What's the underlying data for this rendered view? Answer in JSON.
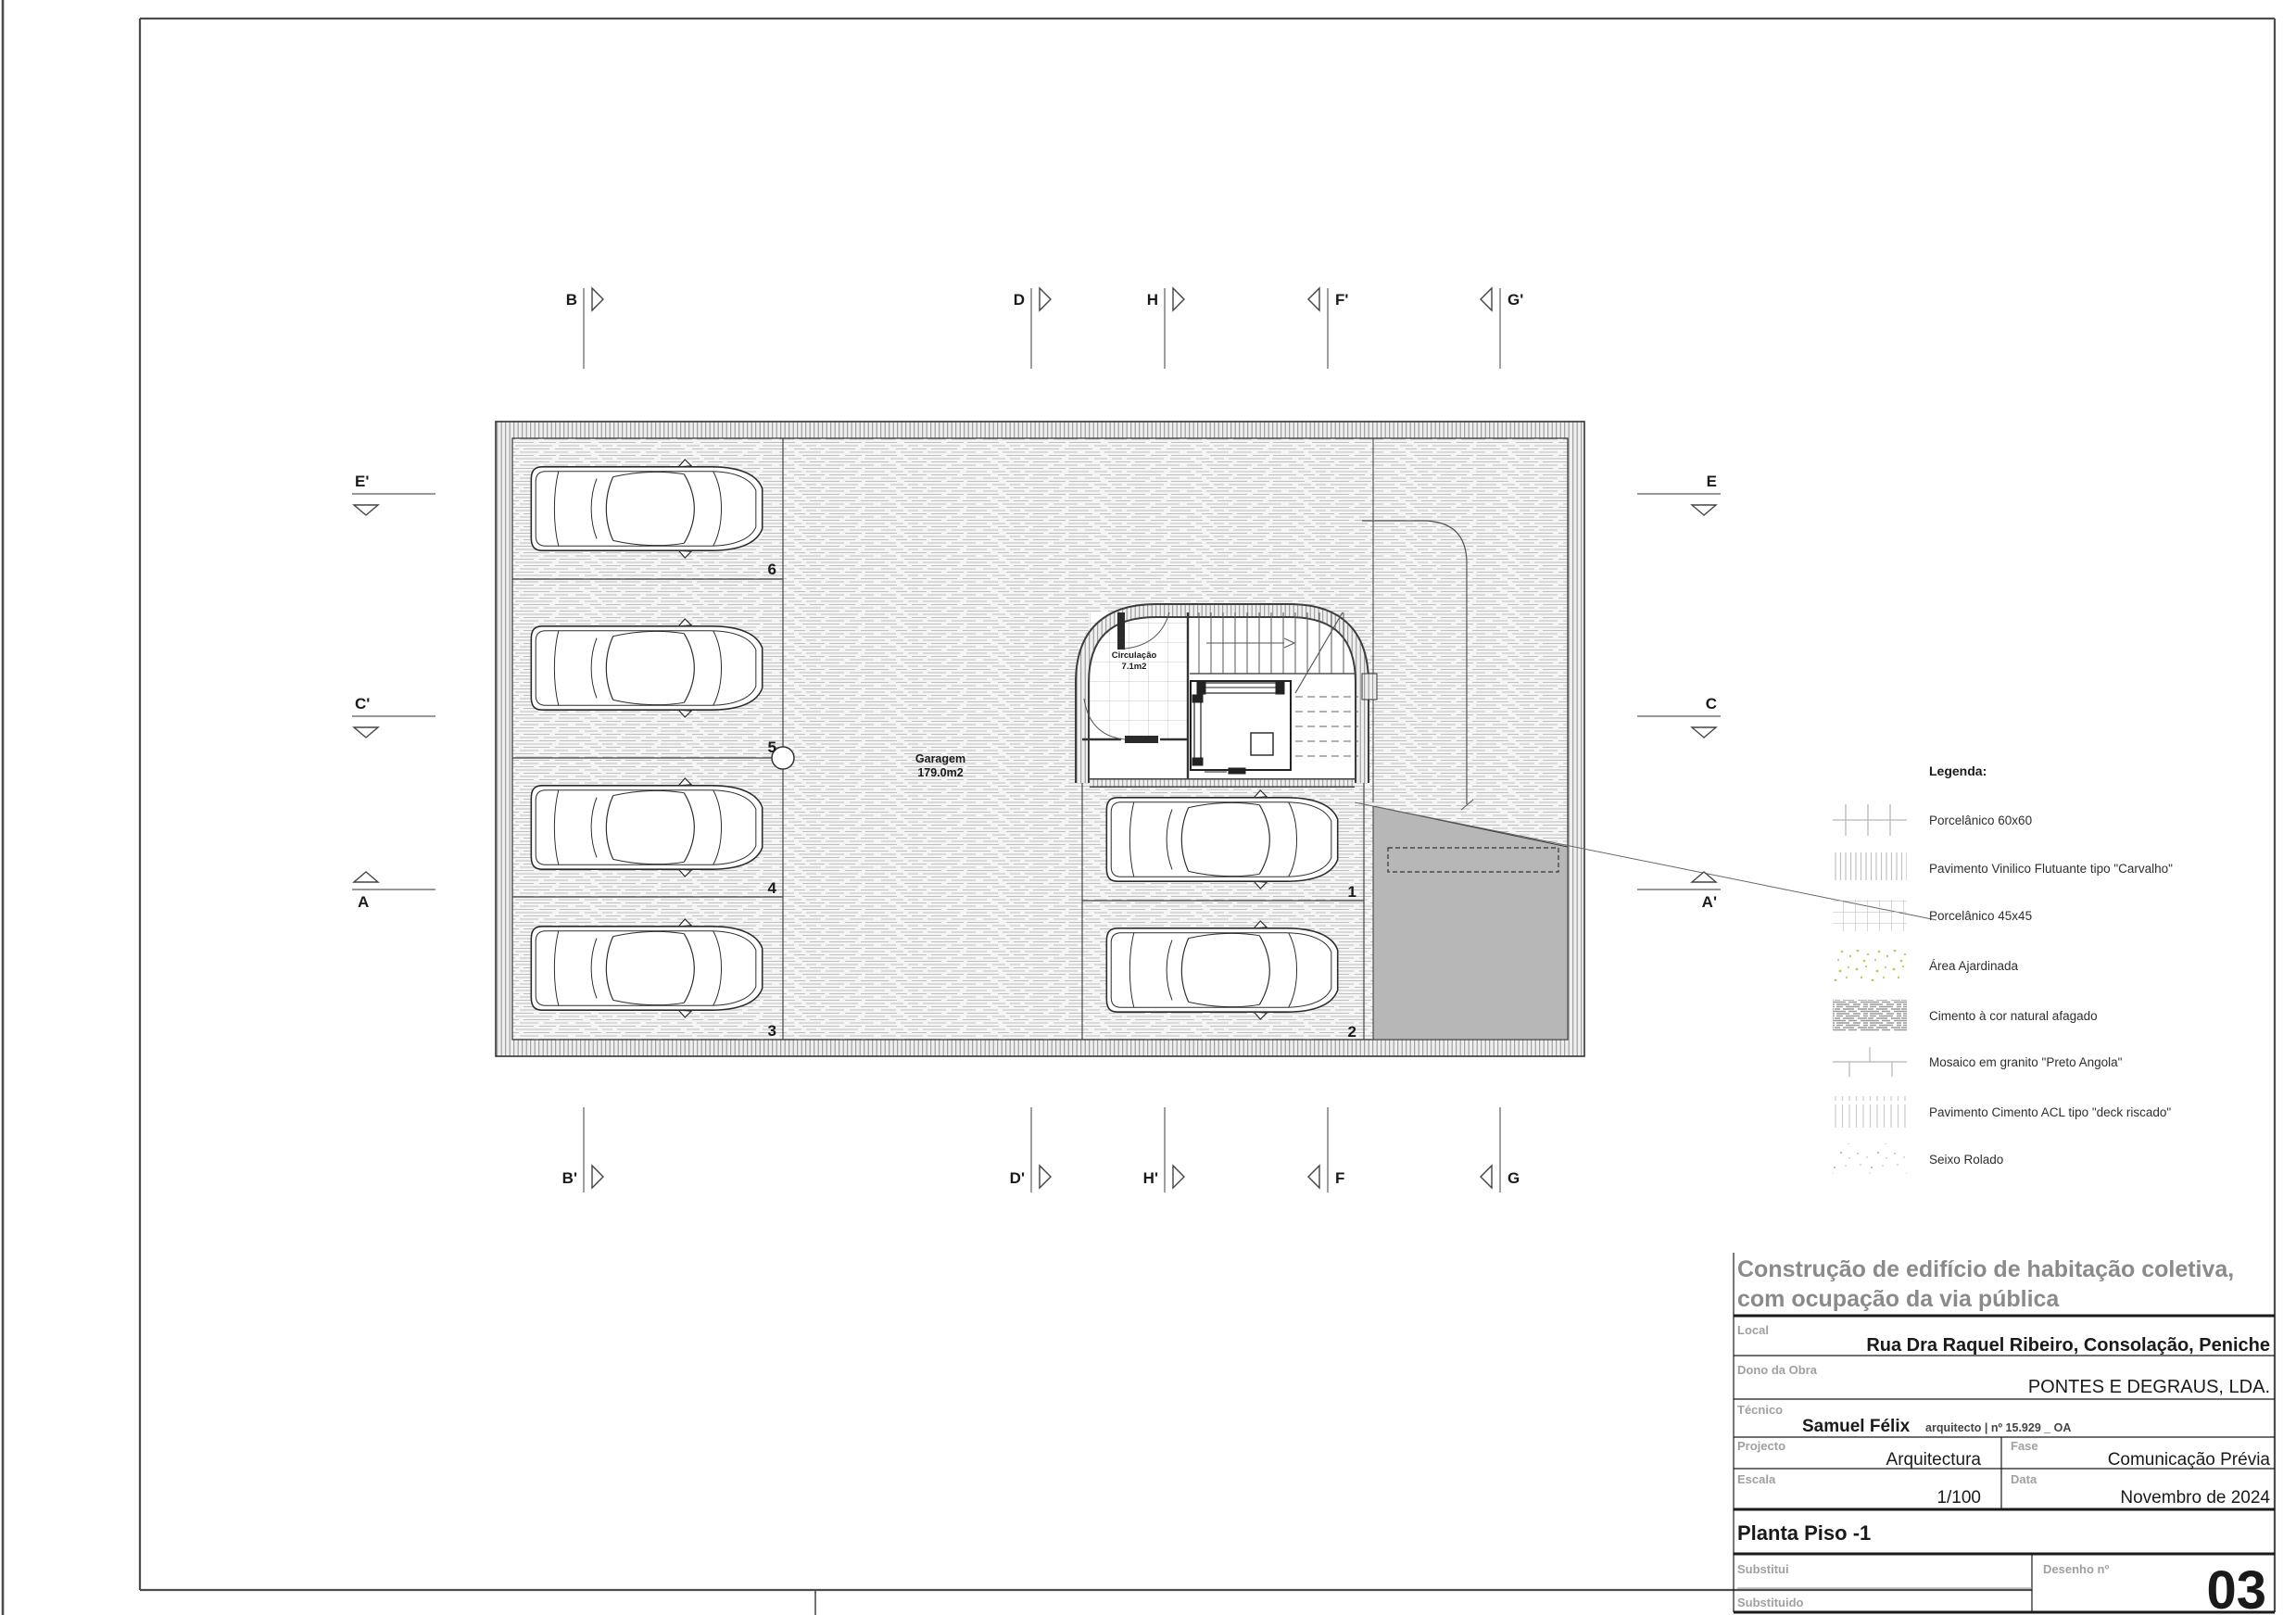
{
  "sheet": {
    "markers": {
      "top": [
        "B",
        "D",
        "H",
        "F'",
        "G'"
      ],
      "bottom": [
        "B'",
        "D'",
        "H'",
        "F",
        "G"
      ],
      "left": [
        "E'",
        "C'",
        "A"
      ],
      "right": [
        "E",
        "C",
        "A'"
      ]
    }
  },
  "plan": {
    "garage_label": "Garagem",
    "garage_area": "179.0m2",
    "circulation_label": "Circulação",
    "circulation_area": "7.1m2",
    "stalls": [
      "6",
      "5",
      "4",
      "3",
      "1",
      "2"
    ]
  },
  "legend": {
    "title": "Legenda:",
    "items": [
      {
        "name": "porcelanico-60x60",
        "label": "Porcelânico 60x60"
      },
      {
        "name": "vinilico-carvalho",
        "label": "Pavimento Vinilico Flutuante tipo \"Carvalho\""
      },
      {
        "name": "porcelanico-45x45",
        "label": "Porcelânico 45x45"
      },
      {
        "name": "area-ajardinada",
        "label": "Área Ajardinada"
      },
      {
        "name": "cimento-afagado",
        "label": "Cimento à cor natural afagado"
      },
      {
        "name": "mosaico-granito",
        "label": "Mosaico em granito \"Preto Angola\""
      },
      {
        "name": "cimento-acl-deck",
        "label": "Pavimento Cimento ACL tipo \"deck riscado\""
      },
      {
        "name": "seixo-rolado",
        "label": "Seixo Rolado"
      }
    ],
    "garden_dot_color": "#b8cc55",
    "hatch_color": "#c4c4c4"
  },
  "titleblock": {
    "project_title_line1": "Construção de edifício de habitação coletiva,",
    "project_title_line2": "com ocupação da via pública",
    "local_label": "Local",
    "local_value": "Rua Dra Raquel Ribeiro, Consolação, Peniche",
    "dono_label": "Dono da Obra",
    "dono_value": "PONTES E DEGRAUS, LDA.",
    "tecnico_label": "Técnico",
    "tecnico_value": "Samuel Félix",
    "tecnico_suffix": "arquitecto | nº 15.929 _ OA",
    "projecto_label": "Projecto",
    "projecto_value": "Arquitectura",
    "fase_label": "Fase",
    "fase_value": "Comunicação Prévia",
    "escala_label": "Escala",
    "escala_value": "1/100",
    "data_label": "Data",
    "data_value": "Novembro de 2024",
    "drawing_title": "Planta Piso -1",
    "substitui_label": "Substitui",
    "substituido_label": "Substituido",
    "desenho_label": "Desenho nº",
    "desenho_number": "03"
  }
}
